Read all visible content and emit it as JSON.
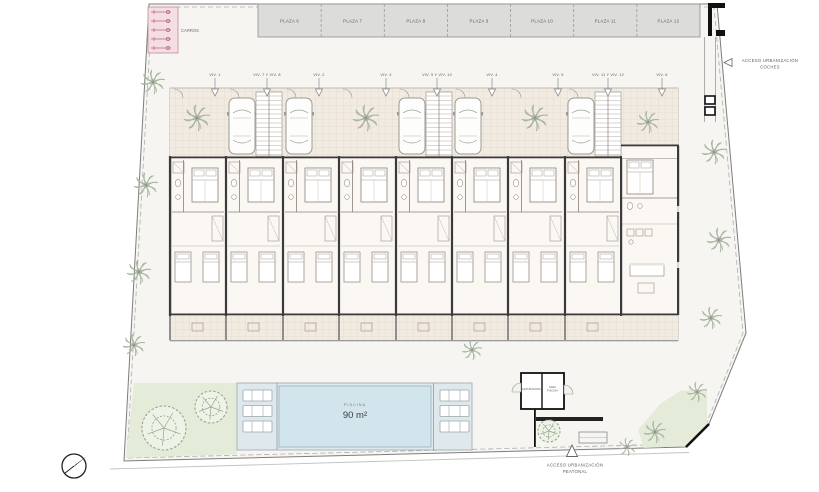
{
  "plan_title": "Site / ground floor plan",
  "parking": {
    "carros_label": "CARROS",
    "plazas": [
      "PLAZA 6",
      "PLAZA 7",
      "PLAZA 8",
      "PLAZA 9",
      "PLAZA 10",
      "PLAZA 11",
      "PLAZA 12"
    ]
  },
  "units": {
    "labels": [
      "VIV. 1",
      "VIV. 7 Y VIV. 8",
      "VIV. 2",
      "VIV. 3",
      "VIV. 9 Y VIV. 10",
      "VIV. 4",
      "VIV. 5",
      "VIV. 11 Y VIV. 12",
      "VIV. 6"
    ]
  },
  "access_cars": {
    "line1": "ACCESO URBANIZACIÓN",
    "line2": "COCHES"
  },
  "access_pedestrian": {
    "line1": "ACCESO URBANIZACIÓN",
    "line2": "PEATONAL"
  },
  "pool": {
    "label": "PISCINA",
    "area": "90 m²"
  },
  "pool_house": {
    "room_left": "DEPURADORA",
    "room_right_line1": "ASEO",
    "room_right_line2": "PISCINA"
  },
  "icons": [
    "north-arrow-icon",
    "palm-tree-icon",
    "tree-icon",
    "car-icon",
    "stairs-icon",
    "bed-icon",
    "lounger-icon",
    "access-arrow-icon"
  ],
  "colors": {
    "site_bg": "#f6f5f1",
    "plaza_fill": "#dcdcda",
    "carros_fill": "#f5dee3",
    "carros_accent": "#b0697a",
    "tile_fill": "#f2ebe1",
    "tile_line": "#ddd2c5",
    "room_fill": "#fbf8f4",
    "wall": "#3b3b3b",
    "heavy": "#111111",
    "pool_deck": "#dfe9ed",
    "pool_water": "#d3e5ec",
    "green": "#e4ecd9",
    "tree": "#98a58e",
    "palm": "#a9b4a1",
    "line_soft": "#a8a098",
    "text": "#5a5a5a"
  }
}
